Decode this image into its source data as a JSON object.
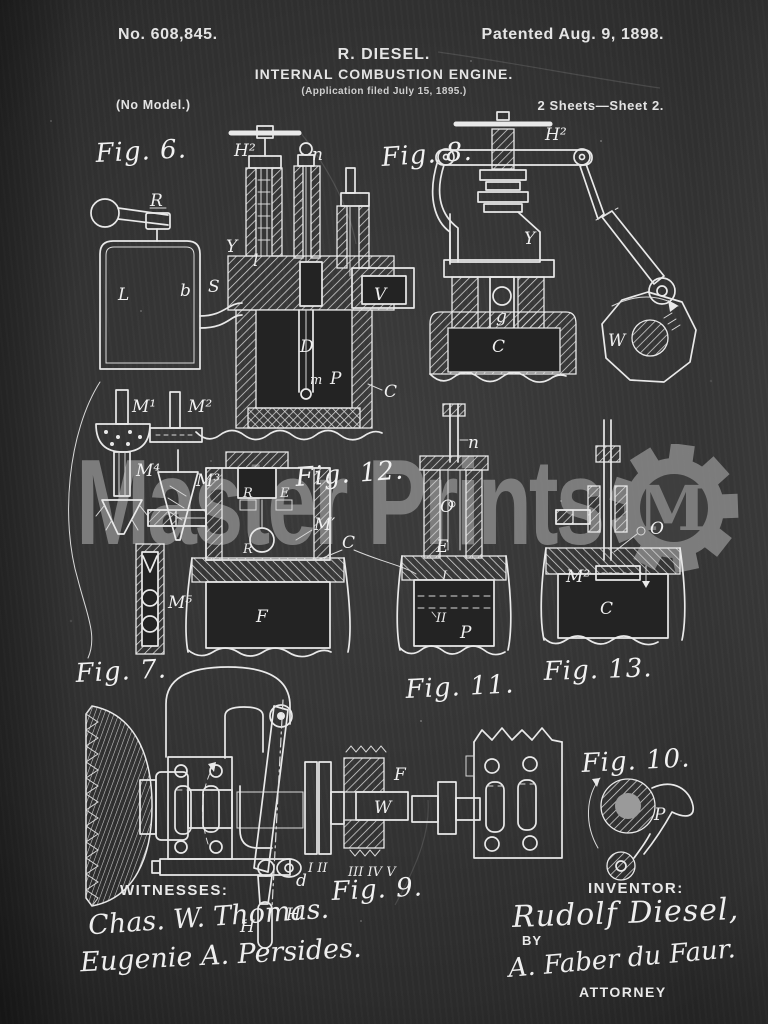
{
  "header": {
    "patent_number": "No. 608,845.",
    "patent_date": "Patented Aug. 9, 1898.",
    "author_line": "R. DIESEL.",
    "title_line": "INTERNAL COMBUSTION ENGINE.",
    "application_line": "(Application filed July 15, 1895.)",
    "no_model": "(No Model.)",
    "sheet_line": "2 Sheets—Sheet 2."
  },
  "watermark": {
    "text": "Master Prints",
    "monogram": "M",
    "color": "#8c8c8c"
  },
  "figures": {
    "fig6": {
      "label": "Fig. 6.",
      "parts": {
        "R": "R",
        "S": "S",
        "l": "l",
        "H2": "H²",
        "n": "n",
        "Y": "Y",
        "L": "L",
        "b": "b",
        "V": "V",
        "D": "D",
        "m": "m",
        "P": "P",
        "C": "C"
      }
    },
    "fig8": {
      "label": "Fig. 8.",
      "parts": {
        "H2": "H²",
        "Y": "Y",
        "g": "g",
        "C": "C",
        "W": "W"
      }
    },
    "fig7": {
      "label": "Fig. 7.",
      "parts": {
        "M1": "M¹",
        "M2": "M²",
        "M3": "M³",
        "M4": "M⁴",
        "M5": "M⁵"
      }
    },
    "fig12": {
      "label": "Fig. 12.",
      "parts": {
        "R": "R",
        "E": "E",
        "R2": "R",
        "Mp": "M′",
        "C": "C",
        "F": "F"
      }
    },
    "fig11": {
      "label": "Fig. 11.",
      "parts": {
        "n": "n",
        "O": "O",
        "E": "E",
        "I": "I",
        "II": "II",
        "P": "P"
      }
    },
    "fig13": {
      "label": "Fig. 13.",
      "parts": {
        "O": "O",
        "M2": "M²",
        "C": "C"
      }
    },
    "fig9": {
      "label": "Fig. 9.",
      "parts": {
        "d": "d",
        "H": "H",
        "Hp": "H′",
        "I_II": "I II",
        "III_IV_V": "III IV V",
        "W": "W",
        "F": "F"
      }
    },
    "fig10": {
      "label": "Fig. 10.",
      "parts": {
        "P": "P"
      }
    }
  },
  "footer": {
    "witnesses_label": "WITNESSES:",
    "witnesses": [
      "Chas. W. Thomas.",
      "Eugenie A. Persides."
    ],
    "inventor_label": "INVENTOR:",
    "inventor_name": "Rudolf Diesel,",
    "by_label": "BY",
    "attorney_signature": "A. Faber du Faur.",
    "attorney_label": "ATTORNEY"
  },
  "colors": {
    "background": "#343434",
    "chalk": "#e9e9e9",
    "watermark": "#8c8c8c"
  }
}
